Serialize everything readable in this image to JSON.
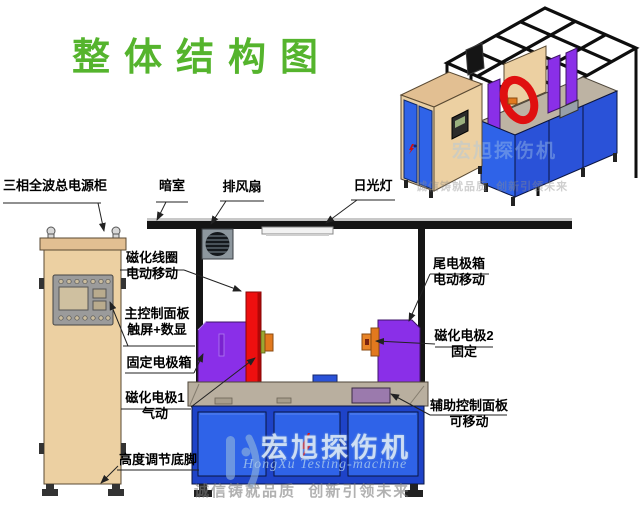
{
  "title": "整体结构图",
  "labels": {
    "power_cabinet": "三相全波总电源柜",
    "dark_room": "暗室",
    "exhaust_fan": "排风扇",
    "fluorescent_lamp": "日光灯",
    "magnetizing_coil": {
      "line1": "磁化线圈",
      "line2": "电动移动"
    },
    "main_control_panel": {
      "line1": "主控制面板",
      "line2": "触屏+数显"
    },
    "fixed_electrode_box": "固定电极箱",
    "magnetizing_electrode_1": {
      "line1": "磁化电极1",
      "line2": "气动"
    },
    "height_adjust_feet": "高度调节底脚",
    "tail_electrode_box": {
      "line1": "尾电极箱",
      "line2": "电动移动"
    },
    "magnetizing_electrode_2": {
      "line1": "磁化电极2",
      "line2": "固定"
    },
    "aux_control_panel": {
      "line1": "辅助控制面板",
      "line2": "可移动"
    }
  },
  "watermark": {
    "brand_cn": "宏旭探伤机",
    "brand_en": "HongXu Testing-machine",
    "slogan": "诚信铸就品质  创新引领未来"
  },
  "colors": {
    "title_green": "#55b42d",
    "machine_blue": "#2f63e8",
    "frame_blue": "#1e43c8",
    "electrode_purple": "#8a2fe8",
    "coil_red": "#ee1010",
    "cabinet_tan": "#ecd0a2",
    "bench_gray": "#b9af9f",
    "electrode_orange": "#e2791e",
    "aux_panel_mauve": "#9b7aad",
    "frame_black": "#151515"
  }
}
